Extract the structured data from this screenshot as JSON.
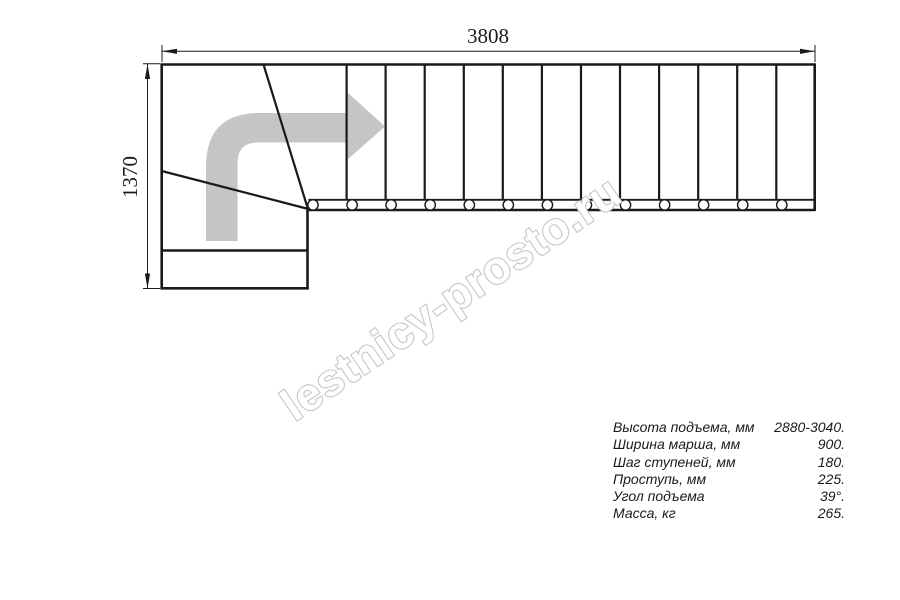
{
  "drawing": {
    "title": "stair-plan-top-view",
    "width_label": "3808",
    "height_label": "1370"
  },
  "watermark": {
    "text": "lestnicy-prosto.ru"
  },
  "specs": {
    "rows": [
      {
        "label": "Высота подъема, мм",
        "value": "2880-3040."
      },
      {
        "label": "Ширина марша, мм",
        "value": "900."
      },
      {
        "label": "Шаг ступеней, мм",
        "value": "180."
      },
      {
        "label": "Проступь, мм",
        "value": "225."
      },
      {
        "label": "Угол подъема",
        "value": "39°."
      },
      {
        "label": "Масса, кг",
        "value": "265."
      }
    ]
  },
  "colors": {
    "line": "#1a1a1a",
    "direction_arrow": "#c5c5c5",
    "watermark_outline": "#c6c6c6",
    "watermark_fill": "#ffffff"
  }
}
